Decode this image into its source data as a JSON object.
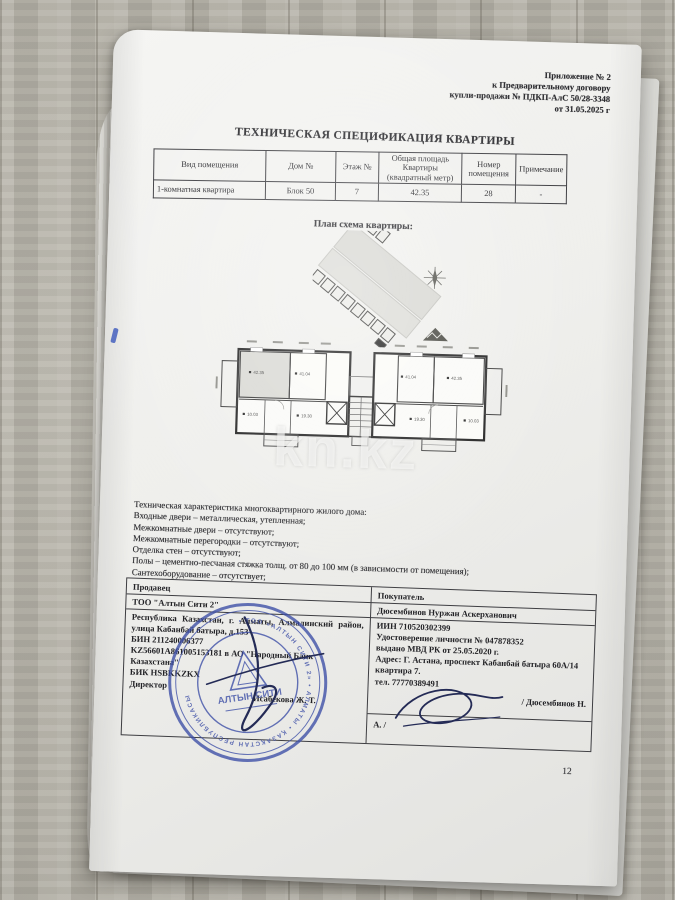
{
  "doc": {
    "header_lines": [
      "Приложение № 2",
      "к Предварительному договору",
      "купли-продажи № ПДКП-АлС 50/28-3348",
      "от 31.05.2025 г"
    ],
    "title": "ТЕХНИЧЕСКАЯ СПЕЦИФИКАЦИЯ КВАРТИРЫ",
    "spec_table": {
      "headers": [
        "Вид помещения",
        "Дом №",
        "Этаж №",
        "Общая площадь Квартиры (квадратный метр)",
        "Номер помещения",
        "Примечание"
      ],
      "row": [
        "1-комнатная квартира",
        "Блок 50",
        "7",
        "42.35",
        "28",
        "-"
      ]
    },
    "plan_label": "План схема квартиры:",
    "floor_plan": {
      "room_labels": [
        "42.35",
        "41.04",
        "10.03",
        "19.30",
        "41.04",
        "42.35",
        "19.30",
        "10.03"
      ]
    },
    "watermark": "kn.kz",
    "tech": {
      "title": "Техническая характеристика многоквартирного жилого дома:",
      "items": [
        "Входные двери – металлическая, утепленная;",
        "Межкомнатные двери – отсутствуют;",
        "Межкомнатные перегородки – отсутствуют;",
        "Отделка стен – отсутствуют;",
        "Полы – цементно-песчаная стяжка толщ. от 80 до 100 мм (в зависимости от помещения);",
        "Сантехоборудование – отсутствует;"
      ]
    },
    "seller": {
      "label": "Продавец",
      "company": "ТОО \"Алтын Сити 2\"",
      "address": "Республика Казахстан, г. Алматы, Алмалинский район, улица Кабанбай батыра, д.153",
      "bin": "БИН 211240006377",
      "account": "KZ56601A861005153181 в АО \"Народный Банк Казахстана\"",
      "bik": "БИК HSBKKZKX",
      "position": "Директор",
      "signatory": "Исабекова Ж. Т."
    },
    "buyer": {
      "label": "Покупатель",
      "name": "Дюсембинов Нуржан Аскерханович",
      "iin": "ИИН 710520302399",
      "id_doc": "Удостоверение личности № 047878352",
      "id_issued": "выдано МВД РК от 25.05.2020 г.",
      "address": "Адрес: Г. Астана, проспект Кабанбай батыра 60А/14 квартира 7.",
      "phone": "тел. 77770389491",
      "sign_prefix": "А. /",
      "sign_suffix": "/ Дюсембинов Н."
    },
    "stamp": {
      "center": "АЛТЫН СИТИ",
      "ring": "• ТОО «АЛТЫН СИТИ 2» • АЛМАТЫ • ҚАЗАҚСТАН РЕСПУБЛИКАСЫ "
    },
    "page_number": "12"
  },
  "colors": {
    "stamp_blue": "#3b4da6",
    "paper": "#efefec",
    "wood": "#b7b4aa",
    "ink": "#2a2a2e",
    "signature": "#242b56"
  }
}
